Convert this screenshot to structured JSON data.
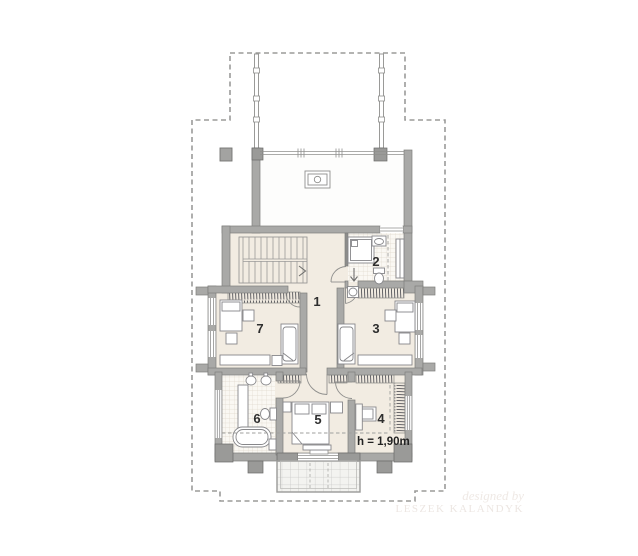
{
  "plan": {
    "rooms": [
      {
        "number": "1"
      },
      {
        "number": "2"
      },
      {
        "number": "3"
      },
      {
        "number": "4"
      },
      {
        "number": "5"
      },
      {
        "number": "6"
      },
      {
        "number": "7"
      }
    ],
    "height_note": "h = 1,90m",
    "watermark": {
      "line1": "designed by",
      "line2": "LESZEK KALANDYK"
    }
  },
  "colors": {
    "background": "#ffffff",
    "wall": "#a9a9a7",
    "wall_outline": "#7e7e7c",
    "pier": "#9a9a98",
    "floor_cream": "#f2ece2",
    "floor_tile": "#faf8f3",
    "tile_grid": "#ddd6ca",
    "top_room_floor": "#fdfdfc",
    "furniture_line": "#87878a",
    "hatch_line": "#55555a",
    "roof_dash": "#9b9b99",
    "label_text": "#2e2e2e"
  }
}
